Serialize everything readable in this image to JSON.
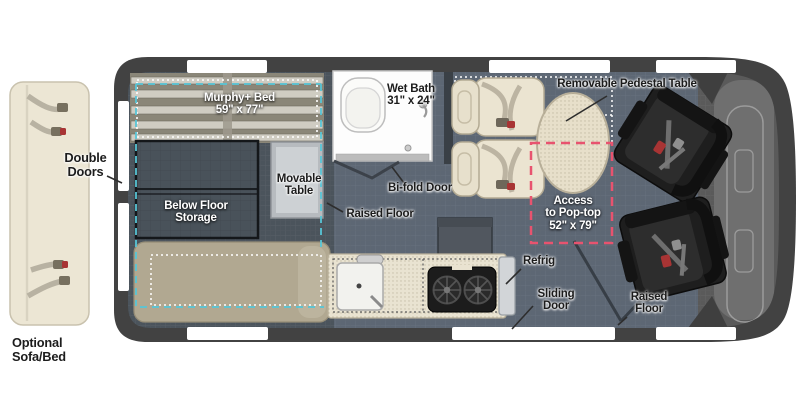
{
  "floorplan": {
    "type": "camper-van-floor-plan",
    "labels": {
      "murphy_bed": {
        "line1": "Murphy+ Bed",
        "line2": "59\" x 77\""
      },
      "double_doors": {
        "line1": "Double",
        "line2": "Doors"
      },
      "below_floor_storage": {
        "line1": "Below Floor",
        "line2": "Storage"
      },
      "movable_table": {
        "line1": "Movable",
        "line2": "Table"
      },
      "wet_bath": {
        "line1": "Wet Bath",
        "line2": "31\" x 24\""
      },
      "bifold_door": {
        "text": "Bi-fold Door"
      },
      "raised_floor_mid": {
        "text": "Raised Floor"
      },
      "removable_pedestal_table": {
        "text": "Removable Pedestal Table"
      },
      "access_pop_top": {
        "line1": "Access",
        "line2": "to Pop-top",
        "line3": "52\" x 79\""
      },
      "refrig": {
        "text": "Refrig"
      },
      "sliding_door": {
        "line1": "Sliding",
        "line2": "Door"
      },
      "raised_floor_right": {
        "line1": "Raised",
        "line2": "Floor"
      },
      "optional_sofa_bed": {
        "line1": "Optional",
        "line2": "Sofa/Bed"
      }
    },
    "colors": {
      "van_body": "#424242",
      "floor_dark": "#4b545c",
      "floor_raised": "#5d6774",
      "cab_gray": "#6f6f6f",
      "cream": "#ebe4d1",
      "tan_sofa": "#b1a891",
      "seat_black": "#1e1e1e",
      "teal_dash": "#58c5d6",
      "pink_dash": "#e8536f",
      "opening_white": "#ffffff"
    }
  }
}
